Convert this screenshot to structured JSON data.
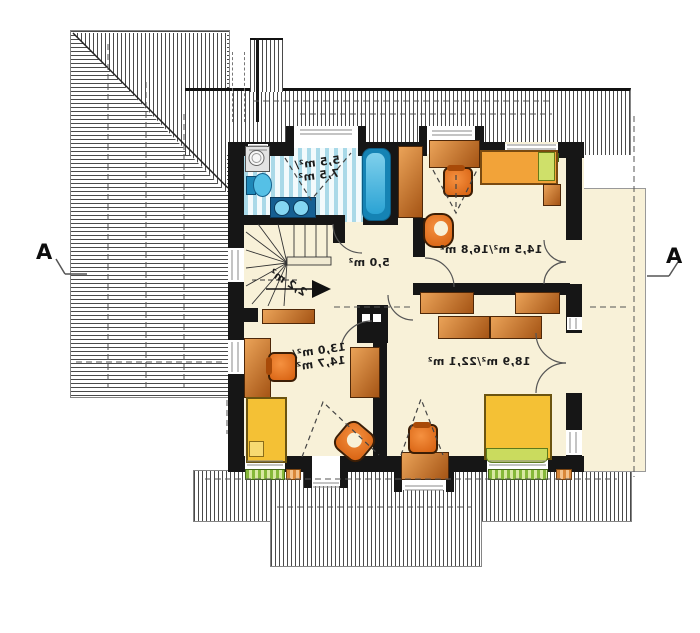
{
  "drawing": {
    "type": "architectural-floor-plan",
    "section_markers": {
      "left": "A",
      "right": "A"
    },
    "room_labels": {
      "bathroom_line1": "5,5 m²/",
      "bathroom_line2": "7,5 m²",
      "bedroom_top_right": "14,5 m²/16,8 m²",
      "hallway": "5,0 m²",
      "staircase": "2,2 m²",
      "bedroom_bottom_left_line1": "13,0 m²/",
      "bedroom_bottom_left_line2": "14,7 m²",
      "bedroom_bottom_right": "18,9 m²/22,1 m²"
    },
    "colors": {
      "floor_cream": "#f8f1d8",
      "wall_black": "#161616",
      "bath_blue": "#2ea8d5",
      "bath_stripe": "#a9d9e8",
      "furniture_brown": "#c8742f",
      "chair_orange": "#e8701a",
      "bed_yellow": "#f4c135",
      "sill_green": "#86b83a",
      "hatch_gray": "#4a4a4a"
    }
  }
}
